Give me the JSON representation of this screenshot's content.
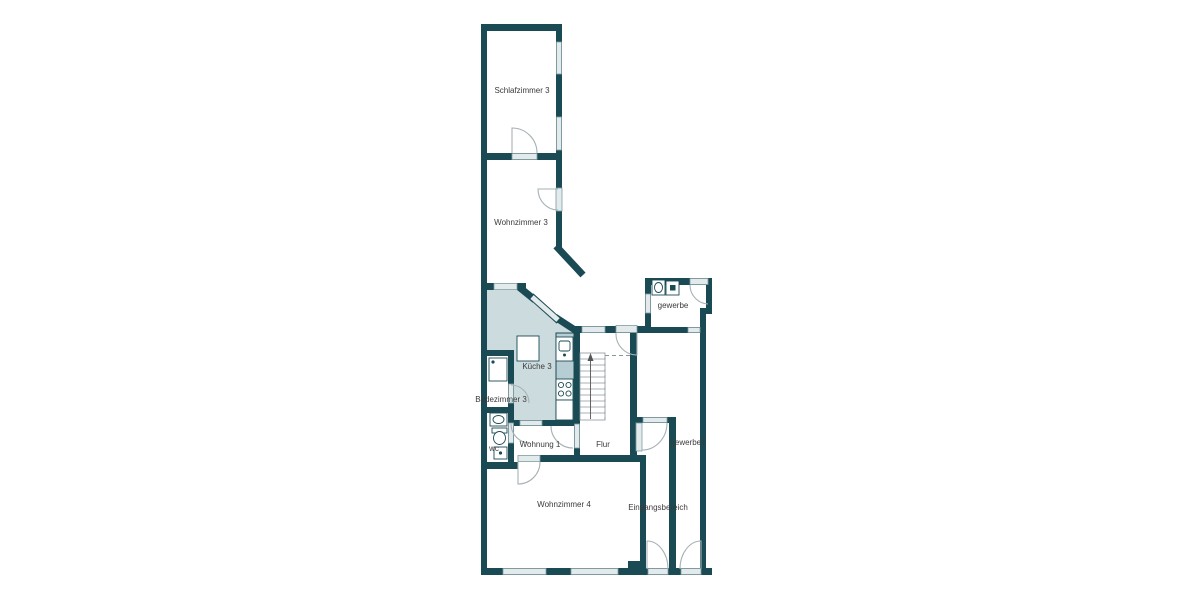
{
  "plan": {
    "type": "floor-plan",
    "rooms": [
      {
        "id": "schlafzimmer3",
        "label": "Schlafzimmer 3"
      },
      {
        "id": "wohnzimmer3",
        "label": "Wohnzimmer 3"
      },
      {
        "id": "kueche3",
        "label": "Küche 3"
      },
      {
        "id": "badezimmer3",
        "label": "Badezimmer 3"
      },
      {
        "id": "wc",
        "label": "wc"
      },
      {
        "id": "wohnung1",
        "label": "Wohnung 1"
      },
      {
        "id": "flur",
        "label": "Flur"
      },
      {
        "id": "gewerbe",
        "label": "gewerbe"
      },
      {
        "id": "gewerbe1",
        "label": "gewerbe1"
      },
      {
        "id": "wohnzimmer4",
        "label": "Wohnzimmer 4"
      },
      {
        "id": "eingangsbereich",
        "label": "Eingangsbereich"
      }
    ],
    "colors": {
      "wall": "#1a4b54",
      "room_fill": "#ccdbde",
      "counter_fill": "#b7cdd4",
      "window_fill": "#e3eaec",
      "door_arc": "#a6b2b6",
      "text": "#3a3a3a",
      "background": "#ffffff"
    }
  }
}
